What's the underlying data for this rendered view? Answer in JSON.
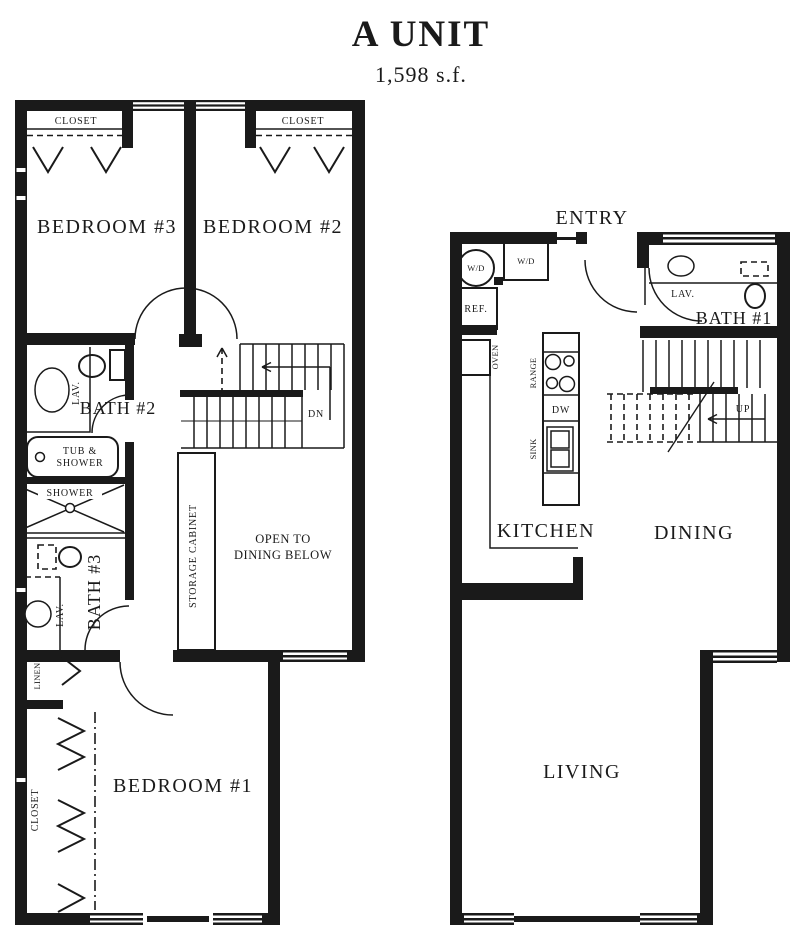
{
  "title": "A UNIT",
  "area": "1,598 s.f.",
  "colors": {
    "ink": "#1a1a1a",
    "paper": "#ffffff"
  },
  "upper_floor": {
    "bedroom3_closet": "CLOSET",
    "bedroom2_closet": "CLOSET",
    "bedroom3": "BEDROOM #3",
    "bedroom2": "BEDROOM #2",
    "bath2": "BATH #2",
    "bath2_lav": "LAV.",
    "tub_line1": "TUB &",
    "tub_line2": "SHOWER",
    "shower": "SHOWER",
    "stairs_down": "DN",
    "bath3": "BATH #3",
    "bath3_lav": "LAV.",
    "linen": "LINEN",
    "storage": "STORAGE CABINET",
    "open_line1": "OPEN TO",
    "open_line2": "DINING BELOW",
    "bedroom1_closet": "CLOSET",
    "bedroom1": "BEDROOM #1"
  },
  "lower_floor": {
    "entry": "ENTRY",
    "wd_left": "W/D",
    "wd_right": "W/D",
    "ref": "REF.",
    "oven": "OVEN",
    "bath1": "BATH #1",
    "bath1_lav": "LAV.",
    "range": "RANGE",
    "dw": "DW",
    "sink": "SINK",
    "kitchen": "KITCHEN",
    "stairs_up": "UP",
    "dining": "DINING",
    "living": "LIVING"
  }
}
